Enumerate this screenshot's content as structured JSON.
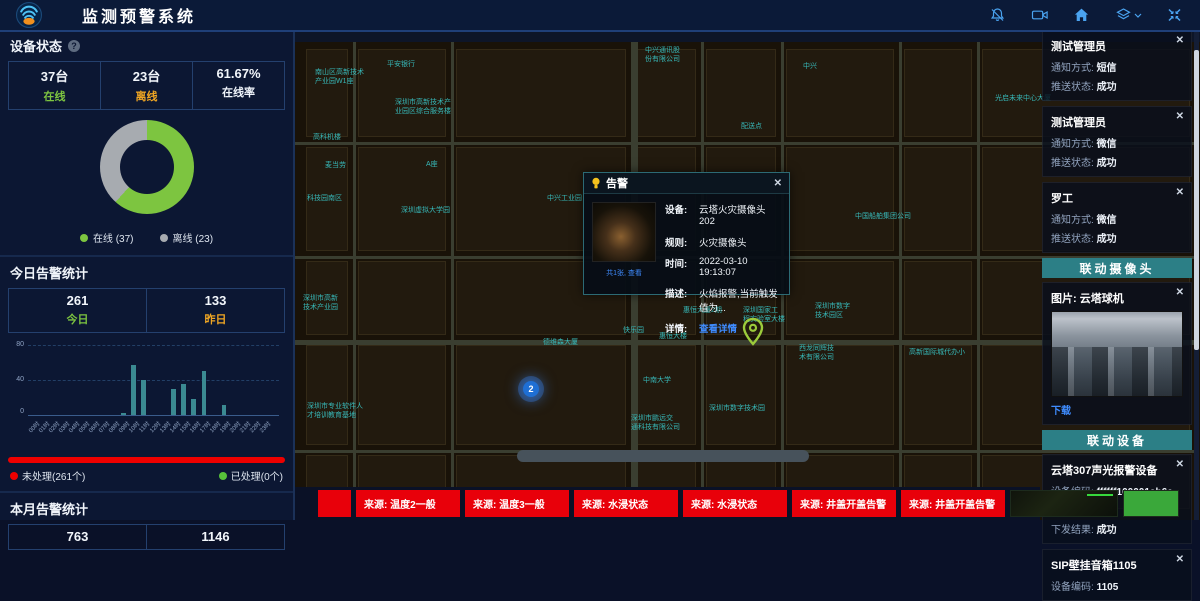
{
  "ui": {
    "close_glyph": "✕",
    "help_glyph": "?"
  },
  "colors": {
    "accent_blue": "#4aa3f0",
    "link_blue": "#3f8cff",
    "green": "#7dc540",
    "orange": "#f0a623",
    "gray": "#a7abb0",
    "red": "#ee0000",
    "bar_teal": "#3b8a92",
    "section_teal": "#2c7f86",
    "map_label": "#37b8b8"
  },
  "header": {
    "title": "监测预警系统",
    "icons": [
      "bell-off-icon",
      "video-camera-icon",
      "home-icon",
      "layers-icon",
      "fullscreen-icon"
    ]
  },
  "left_panel": {
    "device_status": {
      "title": "设备状态",
      "stats": [
        {
          "value": "37台",
          "label": "在线",
          "color": "#7dc540"
        },
        {
          "value": "23台",
          "label": "离线",
          "color": "#f0a623"
        },
        {
          "value": "61.67%",
          "label": "在线率",
          "color": "#eef3fa"
        }
      ],
      "legend": [
        {
          "label": "在线 (37)",
          "color": "#7dc540"
        },
        {
          "label": "离线 (23)",
          "color": "#a7abb0"
        }
      ]
    },
    "today": {
      "title": "今日告警统计",
      "stats": [
        {
          "value": "261",
          "label": "今日",
          "color": "#7dc540"
        },
        {
          "value": "133",
          "label": "昨日",
          "color": "#f0a623"
        }
      ],
      "unhandled": "未处理(261个)",
      "handled": "已处理(0个)"
    },
    "month": {
      "title": "本月告警统计",
      "values": [
        "763",
        "1146"
      ]
    }
  },
  "chart_data": [
    {
      "type": "pie",
      "donut": true,
      "title": "设备状态",
      "labels": [
        "在线",
        "离线"
      ],
      "values": [
        37,
        23
      ],
      "colors": [
        "#7dc540",
        "#a7abb0"
      ],
      "legend_position": "bottom"
    },
    {
      "type": "bar",
      "title": "今日告警统计(按小时)",
      "categories": [
        "00时",
        "01时",
        "02时",
        "03时",
        "04时",
        "05时",
        "06时",
        "07时",
        "08时",
        "09时",
        "10时",
        "11时",
        "12时",
        "13时",
        "14时",
        "15时",
        "16时",
        "17时",
        "18时",
        "19时",
        "20时",
        "21时",
        "22时",
        "23时"
      ],
      "values": [
        0,
        0,
        0,
        0,
        0,
        0,
        0,
        0,
        0,
        2,
        57,
        40,
        0,
        0,
        30,
        35,
        18,
        50,
        0,
        12,
        0,
        0,
        0,
        0
      ],
      "ylim": [
        0,
        80
      ],
      "yticks": [
        0,
        40,
        80
      ],
      "grid": true,
      "bar_color": "#3b8a92"
    }
  ],
  "map": {
    "labels": [
      {
        "text": "中兴通讯股\n份有限公司",
        "x": 350,
        "y": 16
      },
      {
        "text": "中兴",
        "x": 508,
        "y": 32
      },
      {
        "text": "平安银行",
        "x": 92,
        "y": 30
      },
      {
        "text": "南山区高新技术\n产业园W1座",
        "x": 20,
        "y": 38
      },
      {
        "text": "深圳市高新技术产\n业园区综合服务楼",
        "x": 100,
        "y": 68
      },
      {
        "text": "光启未来中心大厦",
        "x": 700,
        "y": 64
      },
      {
        "text": "高科机楼",
        "x": 18,
        "y": 103
      },
      {
        "text": "配送点",
        "x": 446,
        "y": 92
      },
      {
        "text": "麦当劳",
        "x": 30,
        "y": 131
      },
      {
        "text": "A座",
        "x": 131,
        "y": 130
      },
      {
        "text": "科技园南区",
        "x": 12,
        "y": 164
      },
      {
        "text": "深圳虚拟大学园",
        "x": 106,
        "y": 176
      },
      {
        "text": "中兴工业园",
        "x": 252,
        "y": 164
      },
      {
        "text": "中国船舶集团公司",
        "x": 560,
        "y": 182
      },
      {
        "text": "深圳市高新\n技术产业园",
        "x": 8,
        "y": 264
      },
      {
        "text": "德维森大厦",
        "x": 248,
        "y": 308
      },
      {
        "text": "快乐园",
        "x": 328,
        "y": 296
      },
      {
        "text": "惠恒大楼",
        "x": 364,
        "y": 302
      },
      {
        "text": "惠恒大厦2期",
        "x": 388,
        "y": 276
      },
      {
        "text": "深圳国家工\n程实验室大楼",
        "x": 448,
        "y": 276
      },
      {
        "text": "深圳市数字\n技术园区",
        "x": 520,
        "y": 272
      },
      {
        "text": "西龙同辉技\n术有限公司",
        "x": 504,
        "y": 314
      },
      {
        "text": "高新国际城代办小",
        "x": 614,
        "y": 318
      },
      {
        "text": "中南大学",
        "x": 348,
        "y": 346
      },
      {
        "text": "深圳市数字技术园",
        "x": 414,
        "y": 374
      },
      {
        "text": "深圳市鹏远交\n通科技有限公司",
        "x": 336,
        "y": 384
      },
      {
        "text": "深圳市专业软件人\n才培训教育基地",
        "x": 12,
        "y": 372
      }
    ],
    "cluster_marker": {
      "x": 228,
      "y": 351,
      "label": "2"
    },
    "pin_marker": {
      "x": 447,
      "y": 288
    }
  },
  "popup": {
    "title": "告警",
    "image_caption": "共1张, 查看",
    "fields": [
      {
        "label": "设备:",
        "value": "云塔火灾摄像头202"
      },
      {
        "label": "规则:",
        "value": "火灾摄像头"
      },
      {
        "label": "时间:",
        "value": "2022-03-10 19:13:07"
      },
      {
        "label": "描述:",
        "value": "火焰报警,当前触发值为..."
      },
      {
        "label": "详情:",
        "value": "查看详情",
        "link": true
      }
    ]
  },
  "right_panel": {
    "labels": {
      "notify": "通知方式:",
      "push": "推送状态:",
      "code": "设备编码:",
      "service": "调用服务:",
      "result": "下发结果:"
    },
    "notifications": [
      {
        "name": "测试管理员",
        "method": "短信",
        "status": "成功"
      },
      {
        "name": "测试管理员",
        "method": "微信",
        "status": "成功"
      },
      {
        "name": "罗工",
        "method": "微信",
        "status": "成功"
      }
    ],
    "camera_section": {
      "header": "联动摄像头",
      "image_label": "图片: 云塔球机",
      "download": "下载"
    },
    "device_section": {
      "header": "联动设备",
      "devices": [
        {
          "title": "云塔307声光报警设备",
          "code": "ffffff100001ab6c",
          "service": "报警",
          "result": "成功"
        },
        {
          "title": "SIP壁挂音箱1105",
          "code": "1105"
        }
      ]
    }
  },
  "bottom_bar": {
    "alerts": [
      "来源: 温度2一般",
      "来源: 温度3一般",
      "来源: 水浸状态",
      "来源: 水浸状态",
      "来源: 井盖开盖告警",
      "来源: 井盖开盖告警"
    ]
  }
}
